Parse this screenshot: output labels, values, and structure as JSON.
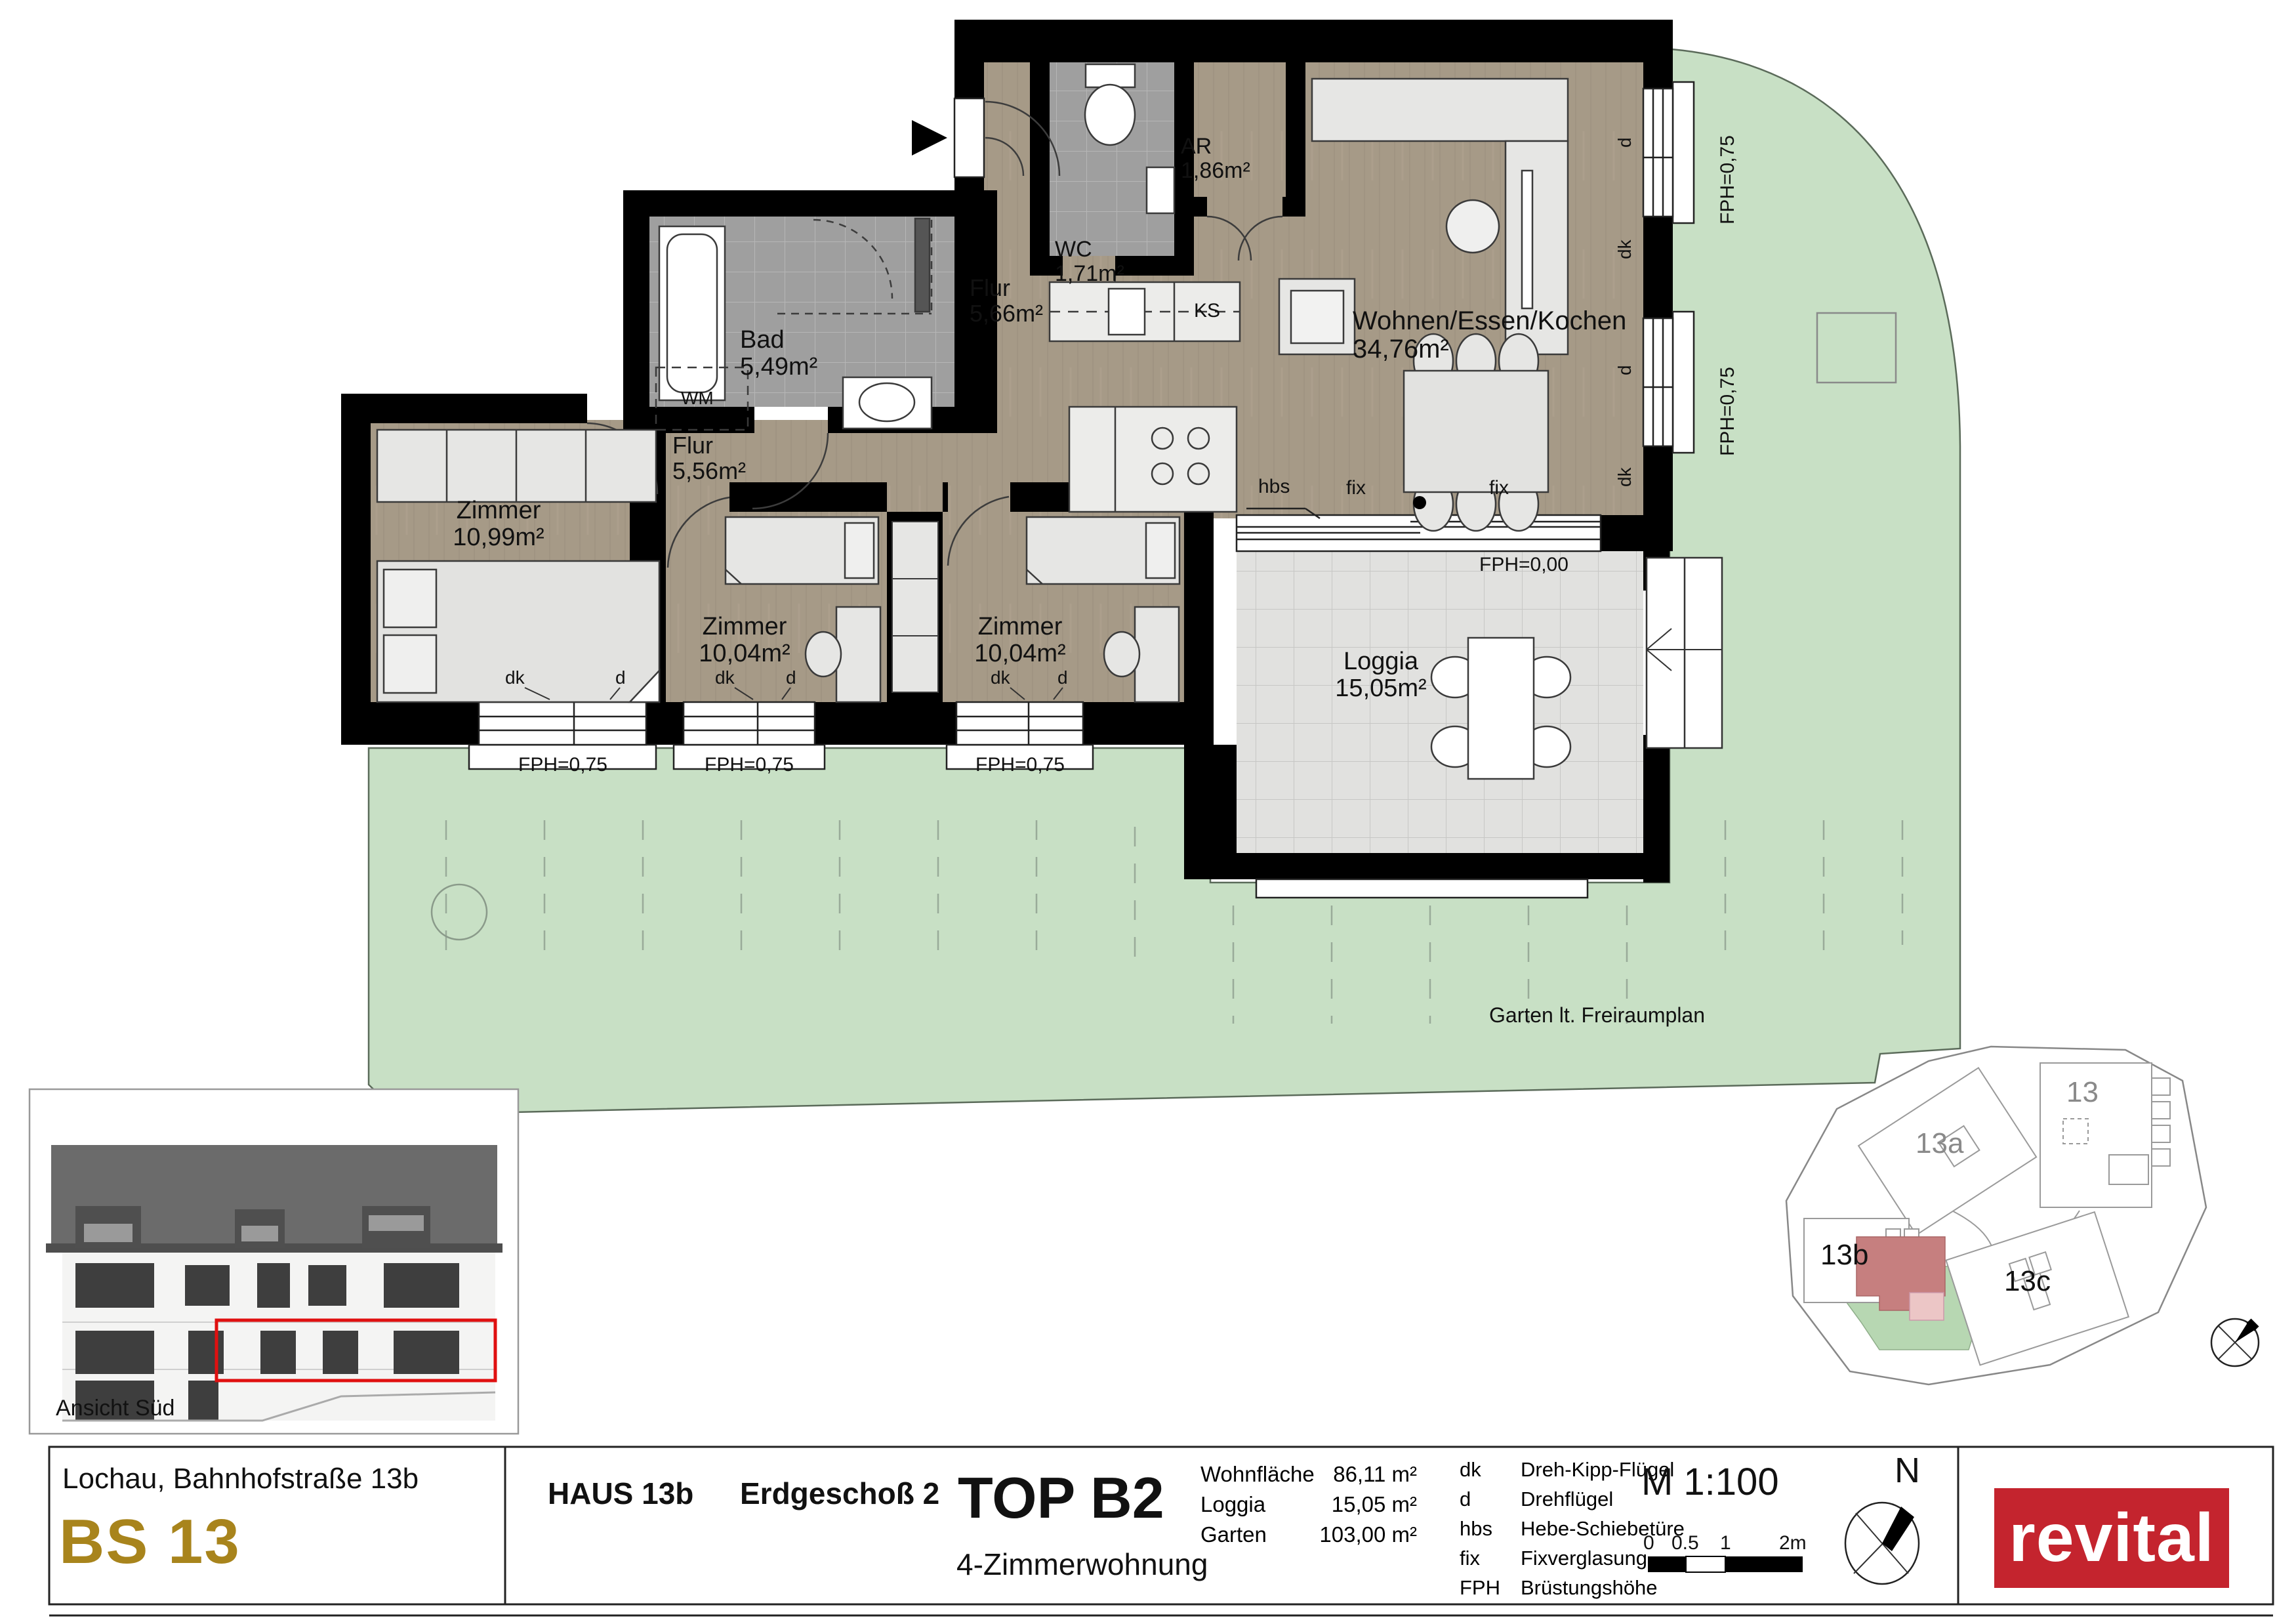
{
  "plan": {
    "rooms": {
      "wc": {
        "name": "WC",
        "area": "1,71m²"
      },
      "ar": {
        "name": "AR",
        "area": "1,86m²"
      },
      "bad": {
        "name": "Bad",
        "area": "5,49m²"
      },
      "flur1": {
        "name": "Flur",
        "area": "5,66m²"
      },
      "flur2": {
        "name": "Flur",
        "area": "5,56m²"
      },
      "zimmer1": {
        "name": "Zimmer",
        "area": "10,99m²"
      },
      "zimmer2": {
        "name": "Zimmer",
        "area": "10,04m²"
      },
      "zimmer3": {
        "name": "Zimmer",
        "area": "10,04m²"
      },
      "wohnen": {
        "name": "Wohnen/Essen/Kochen",
        "area": "34,76m²"
      },
      "loggia": {
        "name": "Loggia",
        "area": "15,05m²"
      }
    },
    "labels": {
      "wm": "WM",
      "ks": "KS",
      "fph075": "FPH=0,75",
      "fph000": "FPH=0,00",
      "dk": "dk",
      "d": "d",
      "hbs": "hbs",
      "fix": "fix",
      "garten": "Garten lt. Freiraumplan"
    }
  },
  "elevation": {
    "caption": "Ansicht Süd"
  },
  "siteplan": {
    "b13": "13",
    "b13a": "13a",
    "b13b": "13b",
    "b13c": "13c"
  },
  "footer": {
    "address": "Lochau, Bahnhofstraße 13b",
    "code": "BS 13",
    "haus": "HAUS 13b",
    "floor": "Erdgeschoß 2",
    "top": "TOP B2",
    "type": "4-Zimmerwohnung",
    "areas": [
      {
        "label": "Wohnfläche",
        "value": "86,11 m²"
      },
      {
        "label": "Loggia",
        "value": "15,05 m²"
      },
      {
        "label": "Garten",
        "value": "103,00 m²"
      }
    ],
    "legend": [
      {
        "abbr": "dk",
        "term": "Dreh-Kipp-Flügel"
      },
      {
        "abbr": "d",
        "term": "Drehflügel"
      },
      {
        "abbr": "hbs",
        "term": "Hebe-Schiebetüre"
      },
      {
        "abbr": "fix",
        "term": "Fixverglasung"
      },
      {
        "abbr": "FPH",
        "term": "Brüstungshöhe"
      }
    ],
    "scale": "M 1:100",
    "scale_ticks": [
      "0",
      "0.5",
      "1",
      "2m"
    ],
    "north": "N",
    "brand": "revital"
  },
  "colors": {
    "garden": "#c8e0c5",
    "wood": "#a69a87",
    "tile": "#a0a0a0",
    "loggia_tile": "#e1e1df",
    "wall": "#000000",
    "accent_gold": "#a8841c",
    "brand_red": "#c4242e",
    "highlight_red": "#e01010",
    "site_unit_red": "#c67f7f",
    "site_unit_pink": "#ecc6c6",
    "site_garden": "#b7d7b2"
  }
}
